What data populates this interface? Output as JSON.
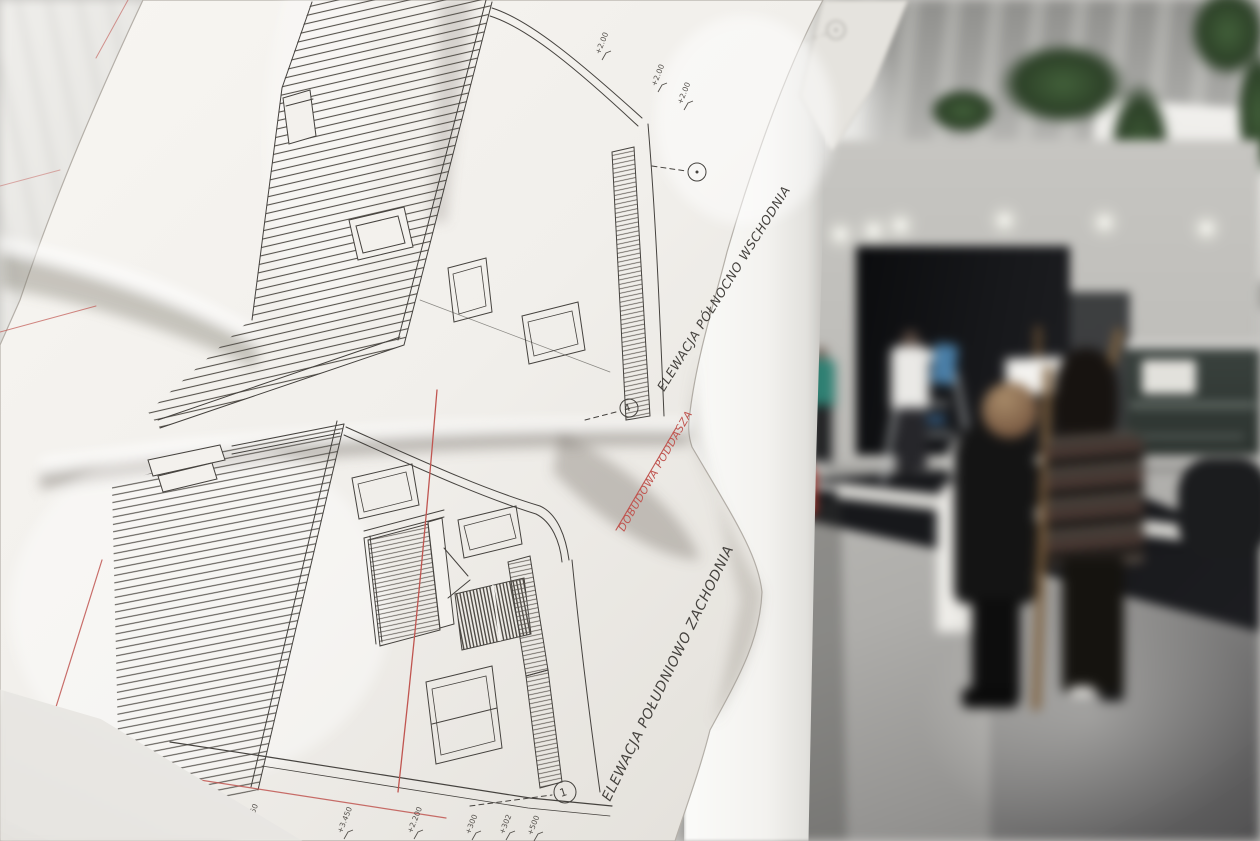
{
  "drawing": {
    "labels": {
      "top_elevation": "ELEWACJA PÓŁNOCNO WSCHODNIA",
      "bottom_elevation": "ELEWACJA POŁUDNIOWO ZACHODNIA",
      "red_note": "DOBUDOWA PODDASZA"
    },
    "axis_markers": {
      "m1": "1",
      "m4": "4"
    },
    "levels": {
      "top_a": "+2.00",
      "top_b": "+2.00",
      "top_c": "+2.00",
      "mid_left": "+3.40",
      "bottom_a": "+5.750",
      "bottom_b": "+3.450",
      "bottom_c": "+2.200",
      "bottom_d": "+300",
      "bottom_e": "+302",
      "bottom_f": "+500"
    }
  },
  "colors": {
    "paper": "#f5f3ef",
    "ink": "#45423e",
    "red_ink": "#c05550",
    "plant_green": "#3d5535",
    "easel_wood": "#8a6a42",
    "teal_shirt": "#2e7f72",
    "blue_panel": "#4a7fa8",
    "extinguisher_red": "#b5362c"
  }
}
